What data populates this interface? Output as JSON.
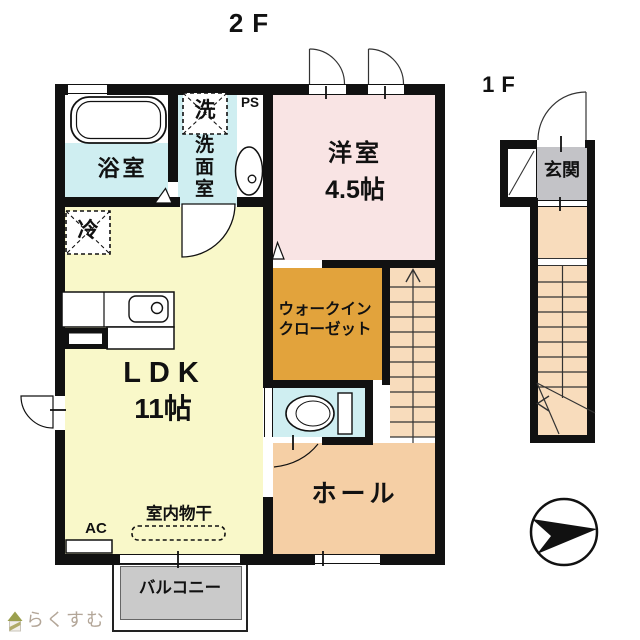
{
  "title": {
    "floor2": "2F",
    "floor1": "1F"
  },
  "rooms": {
    "bathroom": {
      "label": "浴室"
    },
    "washroom": {
      "label": "洗面室",
      "laundry_box": "洗",
      "pipe_space": "PS"
    },
    "western_room": {
      "label": "洋室",
      "size": "4.5帖"
    },
    "ldk": {
      "label": "LDK",
      "size": "11帖",
      "fridge_box": "冷",
      "ac": "AC",
      "indoor_drying": "室内物干"
    },
    "wic": {
      "label_line1": "ウォークイン",
      "label_line2": "クローゼット"
    },
    "hall": {
      "label": "ホール"
    },
    "balcony": {
      "label": "バルコニー"
    },
    "entrance": {
      "label": "玄関"
    }
  },
  "branding": {
    "logo_text": "らくすむ"
  },
  "icons": {
    "compass": "north-arrow",
    "logo": "house-icon"
  },
  "colors": {
    "wall": "#111111",
    "wet_area": "#cfeef1",
    "western_room": "#f9e4e4",
    "ldk": "#f9f8c9",
    "wic": "#e2a33c",
    "stairs": "#f8dcbc",
    "hall": "#f5cfa5",
    "entrance_floor": "#c3c3c7",
    "balcony": "#cacaca",
    "logo_text": "#b3a698"
  }
}
